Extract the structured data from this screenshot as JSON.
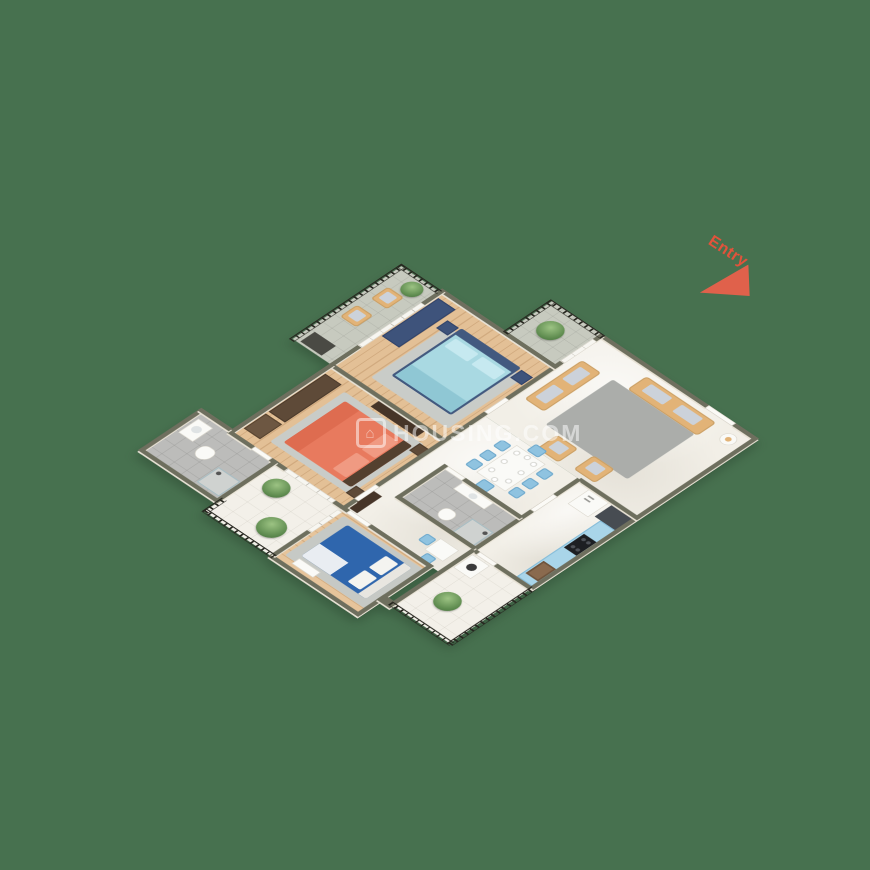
{
  "page": {
    "background_color": "#47714F"
  },
  "watermark": {
    "logo_icon": "⌂",
    "text": "HOUSING.COM",
    "color": "rgba(255,255,255,0.5)"
  },
  "entry_marker": {
    "label": "Entry",
    "color": "#E2533B",
    "arrow": "triangle pointing toward entry door on top-right wall"
  },
  "palette": {
    "background_green": "#47714F",
    "wall_top": "#6E6F5E",
    "wall_face_cream": "#E8E2D5",
    "wood_floor": "#E3C096",
    "marble_floor": "#F2EFE7",
    "grey_tile": "#BCBCBA",
    "balcony_tile": "#C7CABF",
    "railing_black": "#26261F",
    "sofa_tan": "#E2B377",
    "chair_light_blue": "#8FC3E0",
    "kitchen_cabinet_blue": "#A9D5E9",
    "bed_coral": "#E87A5E",
    "bedding_light_blue": "#A9D9E2",
    "bed_dark_blue": "#2F66AD",
    "wardrobe_navy": "#3E537B",
    "wardrobe_brown": "#5E4A38",
    "plant_green": "#5D8A4E"
  },
  "floor_plan": {
    "projection": "3D isometric dollhouse view, rotated 45°",
    "rooms": [
      {
        "name": "living-room",
        "floor": "marble",
        "furniture": [
          "3-seater tan sofa",
          "2-seater tan sofa",
          "2 tan armchairs",
          "grey area rug",
          "round side table with lamp"
        ]
      },
      {
        "name": "bedroom-2",
        "floor": "wood",
        "furniture": [
          "double bed with light-blue bedding and navy frame",
          "navy wardrobe",
          "2 navy nightstands",
          "grey area rug"
        ]
      },
      {
        "name": "master-bedroom",
        "floor": "wood",
        "furniture": [
          "double bed with coral bedding",
          "brown wardrobe",
          "brown dresser",
          "dark TV console",
          "2 nightstands",
          "grey area rug"
        ]
      },
      {
        "name": "bedroom-3",
        "floor": "wood",
        "furniture": [
          "double bed with dark-blue bedding and white pillows",
          "white bench",
          "dark hall cabinet",
          "grey area rug"
        ]
      },
      {
        "name": "kitchen",
        "floor": "marble",
        "furniture": [
          "white refrigerator",
          "dark tall cabinet",
          "light-blue counter along wall",
          "black gas hob",
          "brown sink"
        ]
      },
      {
        "name": "dining-area",
        "floor": "marble",
        "furniture": [
          "white 8-seat dining table with place settings",
          "8 light-blue chairs",
          "small 2-seat breakfast table"
        ]
      },
      {
        "name": "bathroom-1",
        "floor": "grey-tile",
        "furniture": [
          "washbasin",
          "toilet",
          "shower area"
        ]
      },
      {
        "name": "bathroom-2",
        "floor": "grey-tile",
        "furniture": [
          "vanity washbasin",
          "toilet",
          "glass shower enclosure"
        ]
      }
    ],
    "balconies": [
      {
        "name": "north-balcony",
        "features": [
          "black railing",
          "potted plant",
          "sliding glass door to living room"
        ]
      },
      {
        "name": "west-balcony",
        "features": [
          "black railing",
          "2 tan wicker chairs",
          "potted plant",
          "dark AC unit",
          "sliding glass door to bedroom-2"
        ]
      },
      {
        "name": "south-balcony",
        "features": [
          "black railing",
          "2 potted plants",
          "sliding doors to master bedroom and bedroom-3"
        ]
      },
      {
        "name": "utility-balcony",
        "features": [
          "black railing",
          "washing machine",
          "potted plant"
        ]
      }
    ],
    "doors": [
      "entry door on north wall",
      "bedroom-2 door",
      "master-bedroom door",
      "bedroom-3 door",
      "bathroom-1 door",
      "bathroom-2 door",
      "kitchen door",
      "utility door"
    ]
  }
}
